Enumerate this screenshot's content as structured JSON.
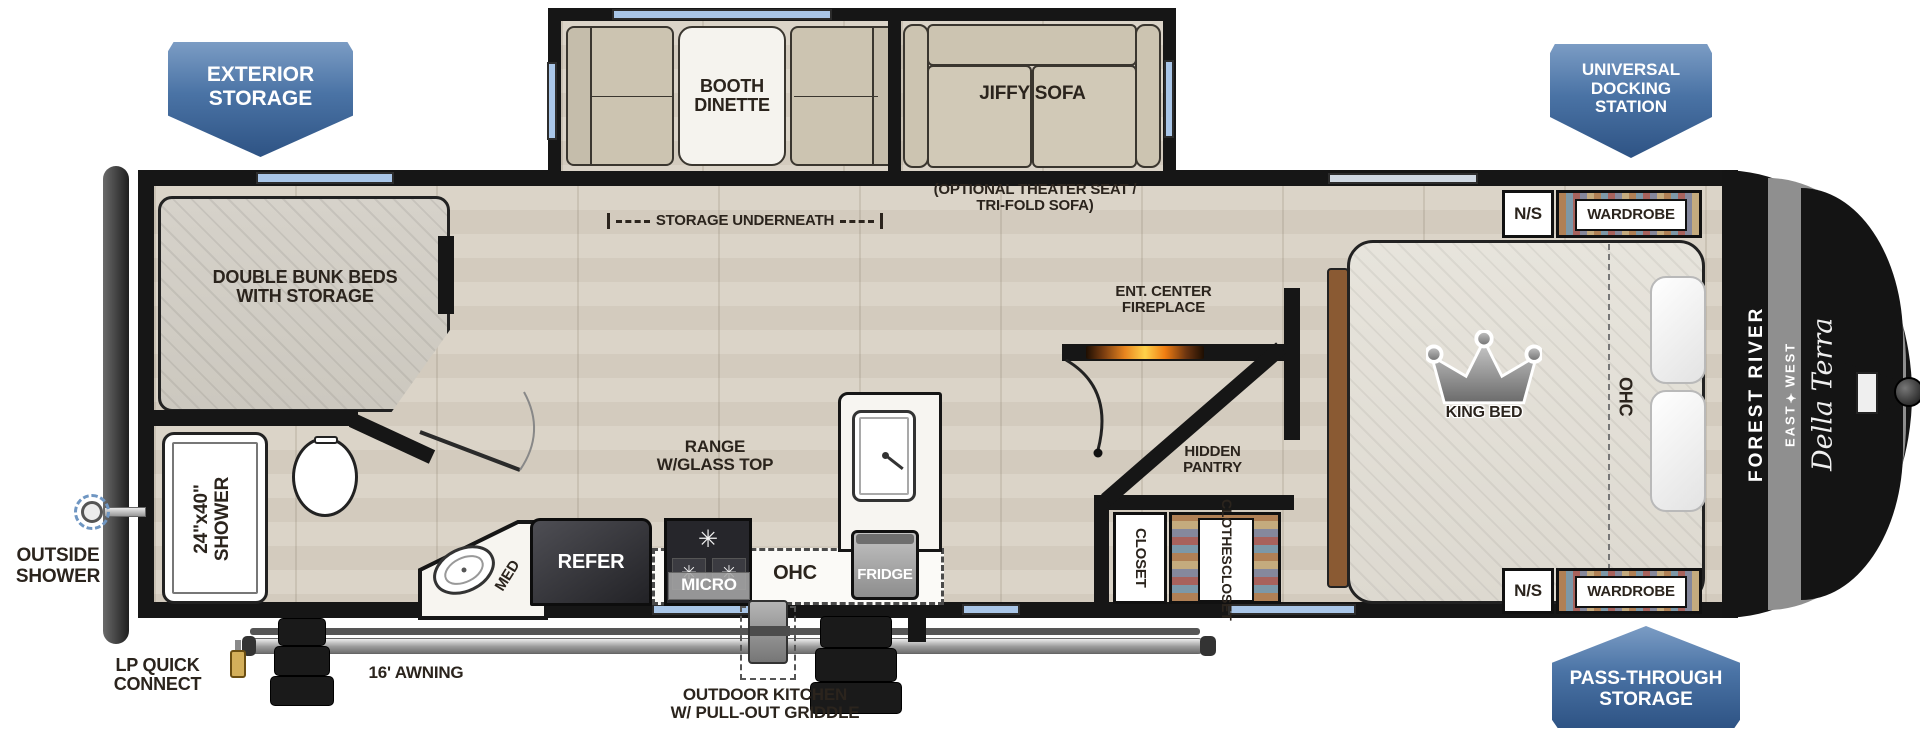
{
  "badges": {
    "exterior_storage": [
      "EXTERIOR",
      "STORAGE"
    ],
    "universal_docking": [
      "UNIVERSAL",
      "DOCKING",
      "STATION"
    ],
    "pass_through": [
      "PASS-THROUGH",
      "STORAGE"
    ]
  },
  "slideouts": {
    "booth_dinette": [
      "BOOTH",
      "DINETTE"
    ],
    "storage_underneath": "STORAGE UNDERNEATH",
    "jiffy_sofa": "JIFFY SOFA",
    "jiffy_option": [
      "(OPTIONAL THEATER SEAT /",
      "TRI-FOLD SOFA)"
    ]
  },
  "rooms": {
    "bunks": [
      "DOUBLE BUNK BEDS",
      "WITH STORAGE"
    ],
    "shower": [
      "24\"x40\"",
      "SHOWER"
    ],
    "med": "MED",
    "refer": "REFER",
    "range": [
      "RANGE",
      "W/GLASS TOP"
    ],
    "micro": "MICRO",
    "ohc_kitchen": "OHC",
    "fridge": "FRIDGE",
    "fireplace": [
      "ENT. CENTER",
      "FIREPLACE"
    ],
    "hidden_pantry": [
      "HIDDEN",
      "PANTRY"
    ],
    "closet": "CLOSET",
    "clothes_closet": [
      "CLOTHES",
      "CLOSET"
    ],
    "king_bed": "KING BED",
    "ohc_bedroom": "OHC",
    "nightstand_top": "N/S",
    "wardrobe_top": "WARDROBE",
    "nightstand_bottom": "N/S",
    "wardrobe_bottom": "WARDROBE"
  },
  "exterior": {
    "outside_shower": [
      "OUTSIDE",
      "SHOWER"
    ],
    "lp_quick_connect": [
      "LP QUICK",
      "CONNECT"
    ],
    "awning": "16' AWNING",
    "outdoor_kitchen": [
      "OUTDOOR KITCHEN",
      "W/ PULL-OUT GRIDDLE"
    ]
  },
  "brand": {
    "manufacturer": "FOREST RIVER",
    "division": "EAST✦WEST",
    "model": "Della Terra"
  },
  "colors": {
    "badge_blue": "#2e5384",
    "window_blue": "#a9c6e8",
    "wall": "#161616",
    "floor": "#d8d1c5",
    "cushion_tan": "#ccc4b1",
    "fire_orange": "#f08c1e"
  }
}
